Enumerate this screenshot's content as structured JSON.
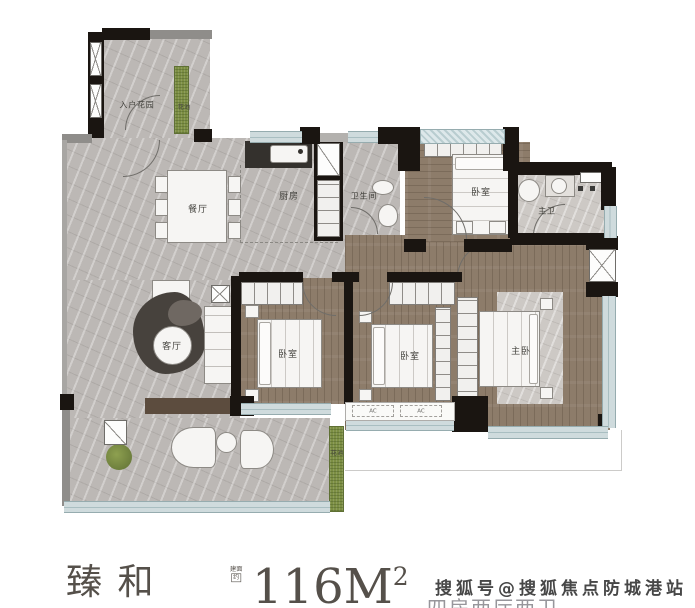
{
  "rooms": {
    "entry_garden": "入户花园",
    "flower_bed_top": "花池",
    "dining": "餐厅",
    "kitchen": "厨房",
    "bathroom": "卫生间",
    "bedroom_top": "卧室",
    "master_bath": "主卫",
    "living": "客厅",
    "bedroom_left": "卧室",
    "bedroom_mid": "卧室",
    "master_bedroom": "主卧",
    "flower_bed_bottom": "花池"
  },
  "ac_units": [
    {
      "label": "AC"
    },
    {
      "label": "AC"
    }
  ],
  "caption": {
    "name": "臻 和",
    "area_prefix_line1": "建面",
    "area_prefix_line2": "约",
    "area_value": "116M",
    "area_sup": "2"
  },
  "watermark": "搜狐号@搜狐焦点防城港站",
  "footer_clipped": "四房两厅两卫",
  "colors": {
    "wall": "#1a1511",
    "marble_floor": "#bcb8b5",
    "wood_floor": "#8d7c6a",
    "window_band": "#cfdbdd",
    "planter_green": "#7c8e43",
    "label_text": "#45443f",
    "caption_text": "#55504a",
    "watermark_text": "#474747"
  }
}
